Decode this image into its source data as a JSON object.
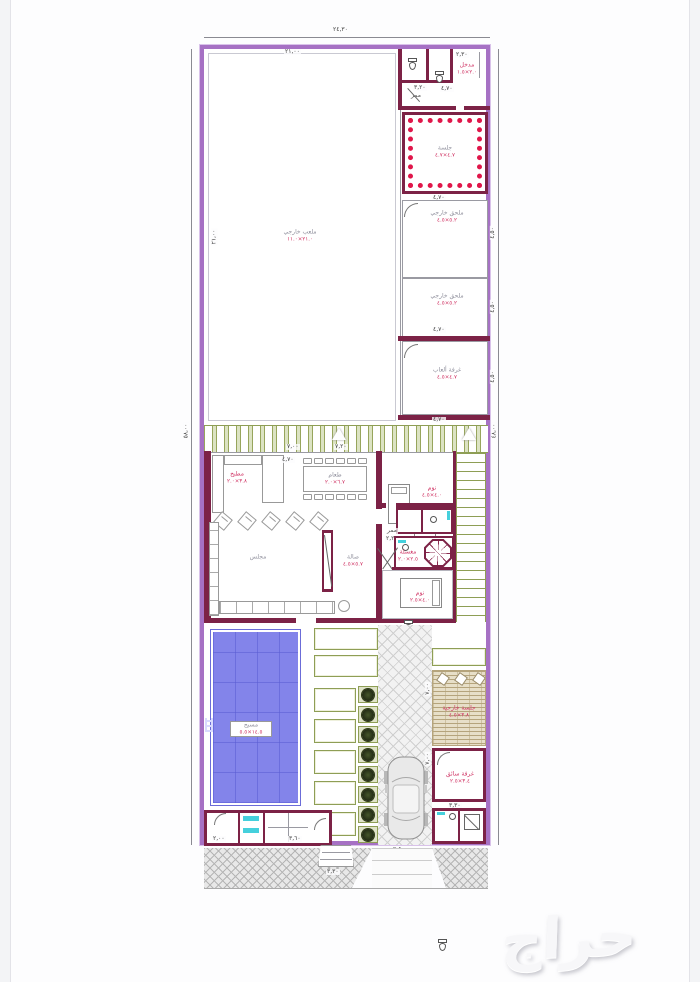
{
  "watermark": "حراج",
  "palette": {
    "wall_purple": "#a671c4",
    "wall_maroon": "#7c2246",
    "accent_red": "#e0164a",
    "label_red": "#d03565",
    "label_gray": "#8f8f9c",
    "green": "#8e9e55",
    "green_bg": "#dce3c3",
    "pool_blue": "#8384ea",
    "pool_grid": "#6b6cd8",
    "cyan": "#45d0dc",
    "tan": "#b5a47c",
    "line": "#8a8a92"
  },
  "dims": {
    "top_total": "٢٤,٣٠",
    "yard_top": "٢١,٠٠",
    "yard_left": "٢١,٠٠",
    "left_total": "٥٨,٠٠",
    "right_total": "٤٨,٠٠",
    "entry_width": "٢,٣٠",
    "corridor_top": "٣,٢٠",
    "majlis_top": "٤,٧٠",
    "annex_top": "٤,٧٠",
    "annex_bottom": "٤,٧٠",
    "games_bottom": "٤,٧٠",
    "annex_side": "٤,٥٠",
    "hall_top": "٧,٠٠",
    "hall_top2": "٧,٢٠",
    "dining_width": "٤,٧٠",
    "corridor_width": "٢,٢٠",
    "drive_width": "٣,٥٠",
    "drive_side": "٧,٠٠",
    "driver_room_width": "٣,٣٠",
    "steps_width": "٣,٣٠",
    "changing_left": "٢,٠٠",
    "changing_right": "٣,٦٠"
  },
  "rooms": {
    "yard": {
      "name": "ملعب خارجي",
      "size": "٢١.٠×١١.٠"
    },
    "entry": {
      "name": "مدخل",
      "size": "٢.٠×١.٥"
    },
    "corridor": {
      "name": "ممر"
    },
    "majlis": {
      "name": "جلسة",
      "size": "٤.٧×٤.٧"
    },
    "annex1": {
      "name": "ملحق خارجي",
      "size": "٥.٢×٤.٥"
    },
    "annex2": {
      "name": "ملحق خارجي",
      "size": "٥.٢×٤.٥"
    },
    "games": {
      "name": "غرفة ألعاب",
      "size": "٤.٧×٤.٥"
    },
    "kitchen": {
      "name": "مطبخ",
      "size": "٣.٨×٢.٠"
    },
    "dining": {
      "name": "طعام",
      "size": "٦.٧×٢.٠"
    },
    "hall": {
      "name": "مجلس"
    },
    "salah": {
      "name": "صالة",
      "size": "٥.٧×٤.٥"
    },
    "bedroom1": {
      "name": "نوم",
      "size": "٤.٠×٤.٥"
    },
    "corridor2": {
      "name": "ممر"
    },
    "laundry": {
      "name": "مغسلة",
      "size": "٢.٥×٢.٠"
    },
    "bedroom2": {
      "name": "نوم",
      "size": "٤.٠×٢.٥"
    },
    "pool": {
      "name": "مسبح",
      "size": "١٤.٥×٥.٥"
    },
    "pergola": {
      "name": "جلسة خارجية",
      "size": "٣.٨×٤.٥"
    },
    "driver": {
      "name": "غرفة سائق",
      "size": "٣.٤×٢.٥"
    }
  },
  "counts": {
    "trees": 8,
    "planters_left": 5,
    "planters_top": 2,
    "dining_chairs": 6,
    "armchairs": 5,
    "pergola_chairs": 3
  }
}
